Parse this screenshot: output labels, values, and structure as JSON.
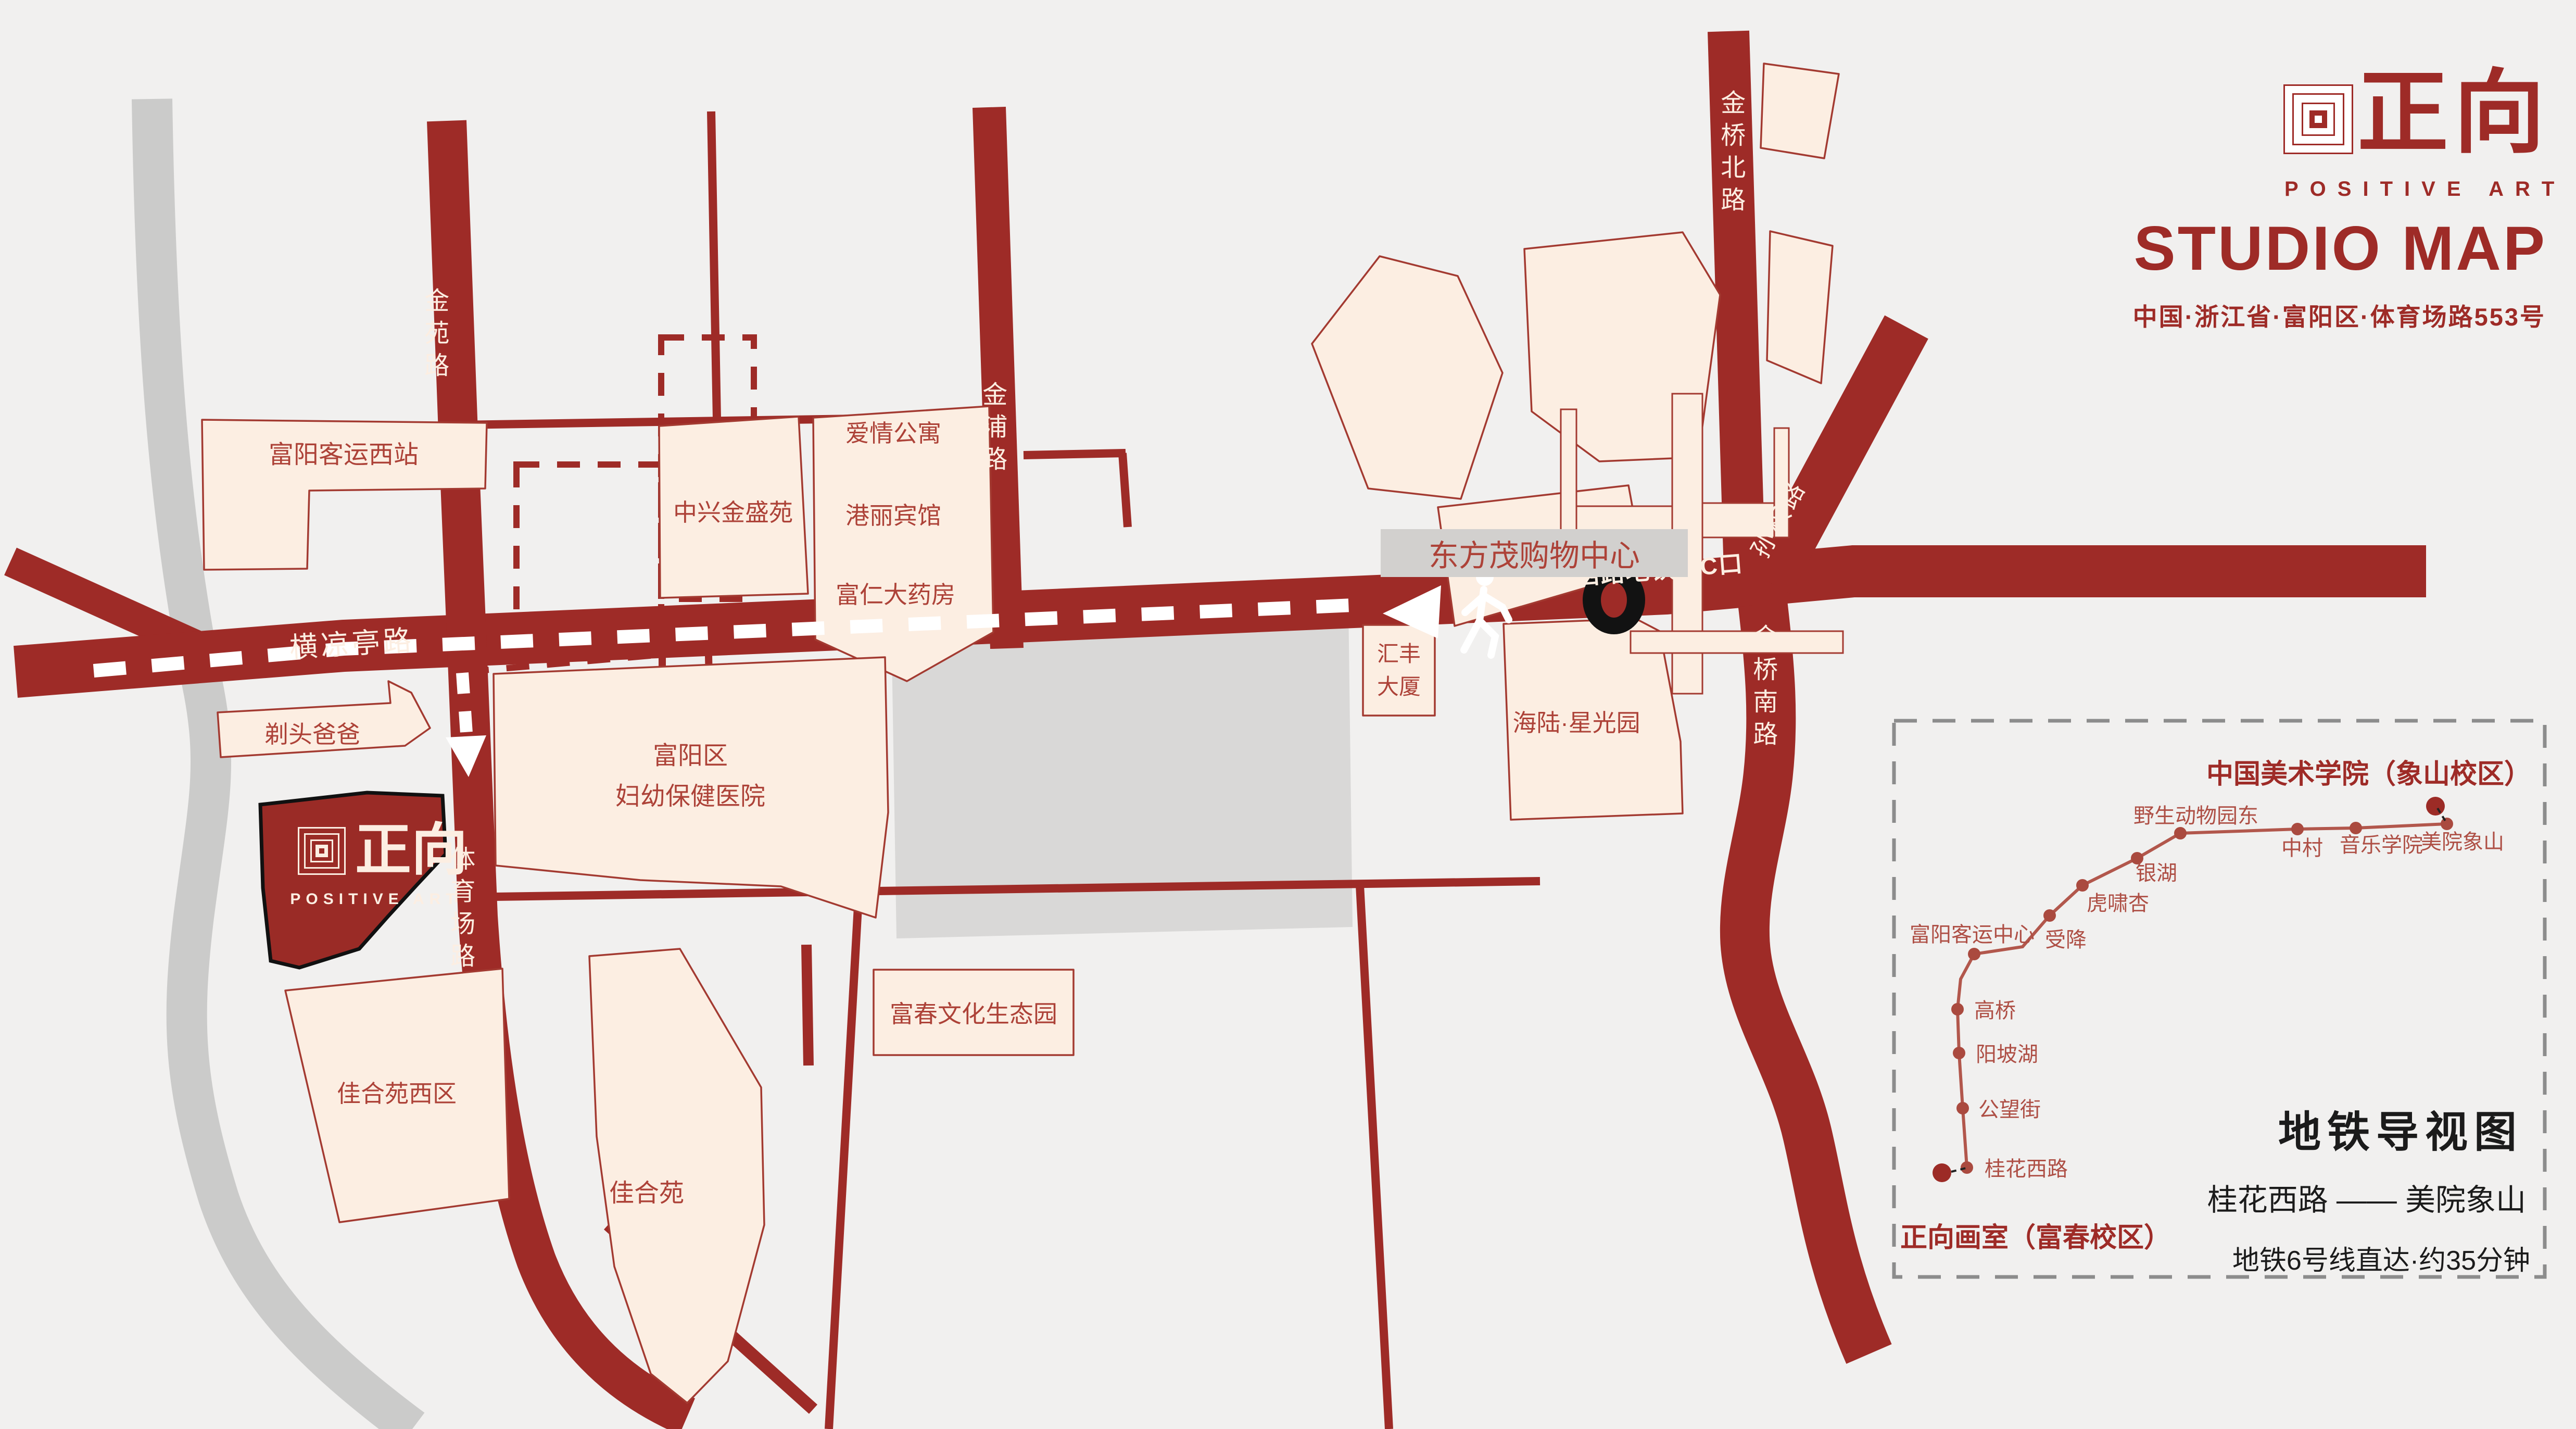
{
  "brand": {
    "logo_cn": "正向",
    "logo_en": "POSITIVE ART",
    "title": "STUDIO MAP",
    "address": "中国·浙江省·富阳区·体育场路553号"
  },
  "studio_marker": {
    "logo_cn": "正向",
    "logo_en": "POSITIVE ART"
  },
  "roads": {
    "jinyuan": "金苑路",
    "hengliangting": "横凉亭路",
    "tiyuchang": "体育场路",
    "jinpu": "金浦路",
    "jinqiao_north": "金桥北路",
    "jinqiao_south": "金桥南路",
    "sunquan": "孙权路",
    "metro_exit": "桂花西路地铁站C口"
  },
  "places": {
    "fuyang_west_station": "富阳客运西站",
    "titou_baba": "剃头爸爸",
    "zhongxing": "中兴金盛苑",
    "aiqing": "爱情公寓",
    "gangli": "港丽宾馆",
    "furen": "富仁大药房",
    "dongfangmao": "东方茂购物中心",
    "huifeng": "汇丰大厦",
    "hailu": "海陆·星光园",
    "hospital_line1": "富阳区",
    "hospital_line2": "妇幼保健医院",
    "jiaheyuan_west": "佳合苑西区",
    "jiaheyuan": "佳合苑",
    "fuchun_park": "富春文化生态园"
  },
  "subway": {
    "panel_title": "地铁导视图",
    "terminus_top": "中国美术学院（象山校区）",
    "terminus_bottom": "正向画室（富春校区）",
    "route": "桂花西路 —— 美院象山",
    "note": "地铁6号线直达·约35分钟",
    "stations": [
      "桂花西路",
      "公望街",
      "阳坡湖",
      "高桥",
      "富阳客运中心",
      "受降",
      "虎啸杏",
      "银湖",
      "野生动物园东",
      "中村",
      "音乐学院",
      "美院象山"
    ]
  },
  "colors": {
    "brand_red": "#9E2B27",
    "cream": "#FCEEE2",
    "line_red": "#B2574C",
    "gray_block": "#D9D8D7",
    "river_gray": "#CBCBCA",
    "black": "#1A1A1A"
  }
}
